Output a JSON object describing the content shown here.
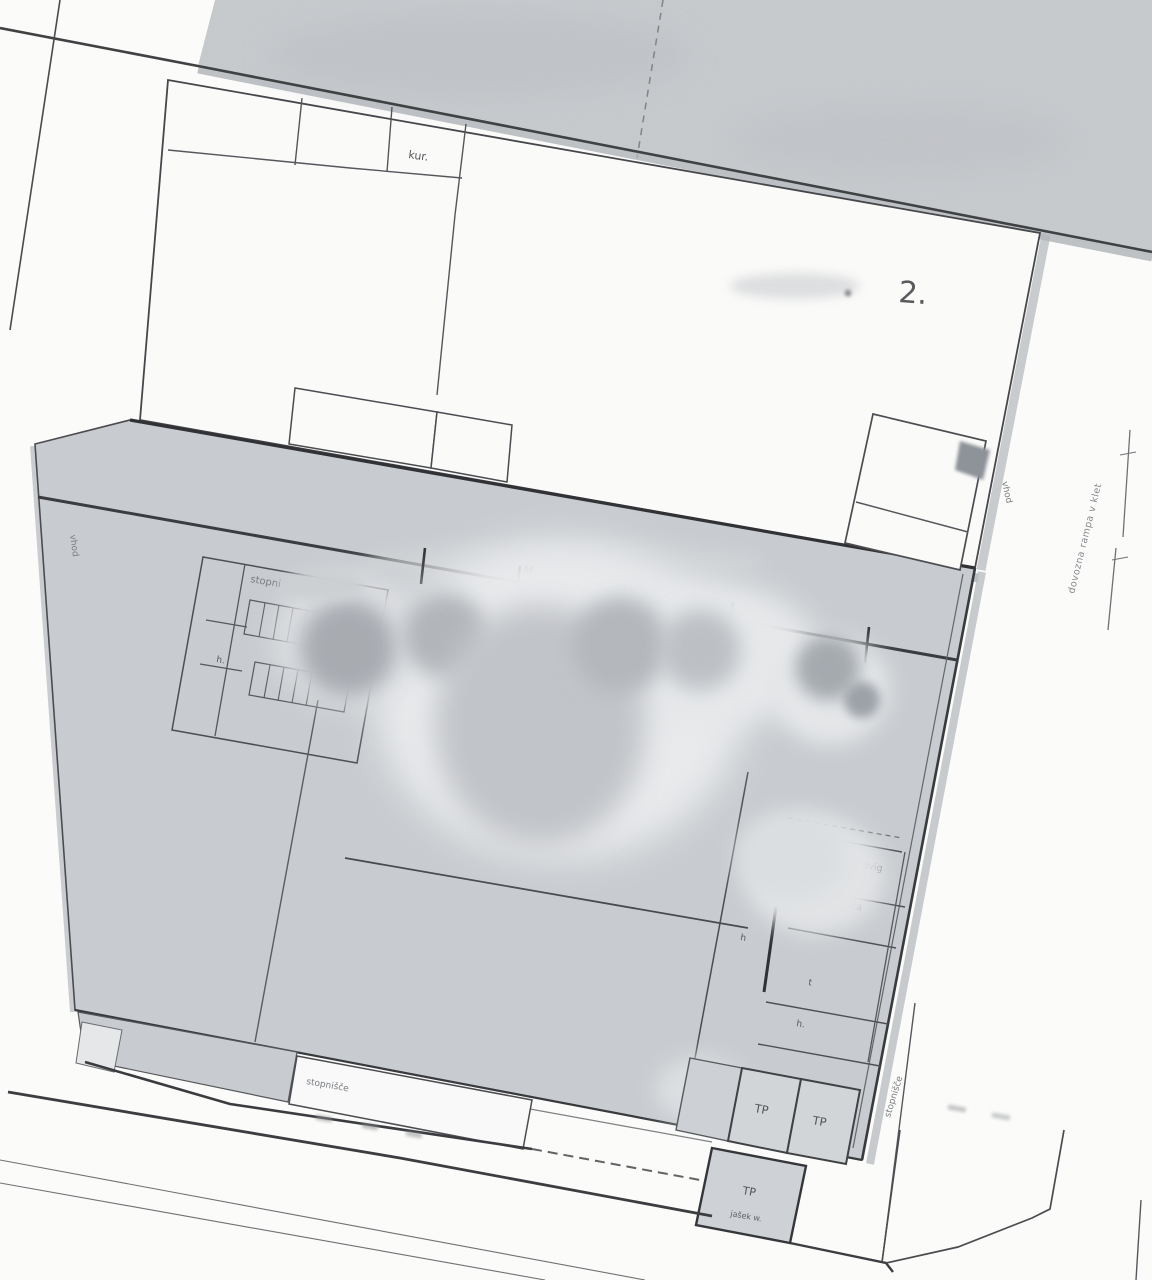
{
  "document": {
    "kind": "scanned floor plan"
  },
  "labels": {
    "room_kur": "kur.",
    "floor_number": "2.",
    "stairs_upper": "stopni",
    "h_stairs": "h.",
    "column_mark": "M",
    "elevator_line1": "dvig",
    "elevator_line2": "ica",
    "t_cell": "t",
    "h_mid": "h",
    "h_lower": "h.",
    "tp_cell_1": "TP",
    "tp_cell_2": "TP",
    "tp_shaft": "TP",
    "shaft_caption": "jašek w.",
    "stairs_bottom": "stopnišče",
    "stairs_right": "stopnišče",
    "entrance_left": "vhod",
    "entrance_right": "vhod",
    "ramp_note": "dovozna rampa v klet"
  },
  "colors": {
    "paper": "#fcfcfb",
    "road_gray": "#c7cacd",
    "building_gray": "#c9ccd0",
    "cell_gray": "#d3d6d9",
    "line_dark": "#3a3b3e",
    "halo_gray": "#aeb3b8"
  }
}
